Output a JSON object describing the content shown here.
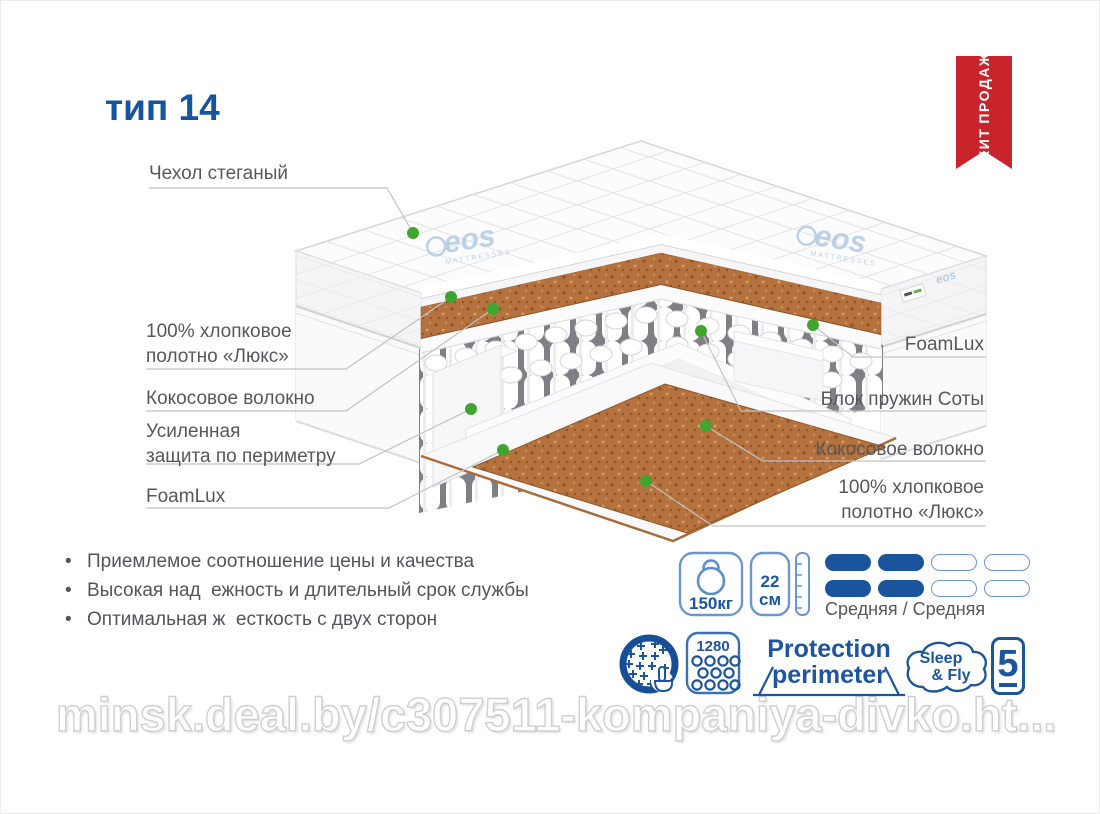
{
  "title": "тип 14",
  "badge": {
    "line1": "ХИТ",
    "line2": "ПРОДАЖ",
    "color": "#c9242b"
  },
  "brand": {
    "name": "eos",
    "sub": "MATTRESSES"
  },
  "callouts_left": [
    {
      "label": "Чехол стеганый"
    },
    {
      "label": "100% хлопковое\nполотно «Люкс»"
    },
    {
      "label": "Кокосовое волокно"
    },
    {
      "label": "Усиленная\nзащита по периметру"
    },
    {
      "label": "FoamLux"
    }
  ],
  "callouts_right": [
    {
      "label": "FoamLux"
    },
    {
      "label": "Блок пружин Соты"
    },
    {
      "label": "Кокосовое волокно"
    },
    {
      "label": "100% хлопковое\nполотно «Люкс»"
    }
  ],
  "features": [
    "Приемлемое соотношение цены и качества",
    "Высокая над  ежность и длительный срок службы",
    "Оптимальная ж  есткость с двух сторон"
  ],
  "specs": {
    "max_load": "150кг",
    "height_value": "22",
    "height_unit": "см",
    "firmness_label": "Средняя / Средняя",
    "firmness_filled": 2,
    "firmness_total": 4,
    "springs_count": "1280",
    "protection_line1": "Protection",
    "protection_line2": "perimeter",
    "brand_line1": "Sleep",
    "brand_line2": "& Fly",
    "warranty_years": "5"
  },
  "watermark": "minsk.deal.by/c307511-kompaniya-divko.ht...",
  "colors": {
    "accent_blue": "#15559f",
    "icon_blue": "#1d559b",
    "badge_red": "#c9242b",
    "green_dot": "#3fa52f",
    "coco_brown": "#b5713e"
  }
}
